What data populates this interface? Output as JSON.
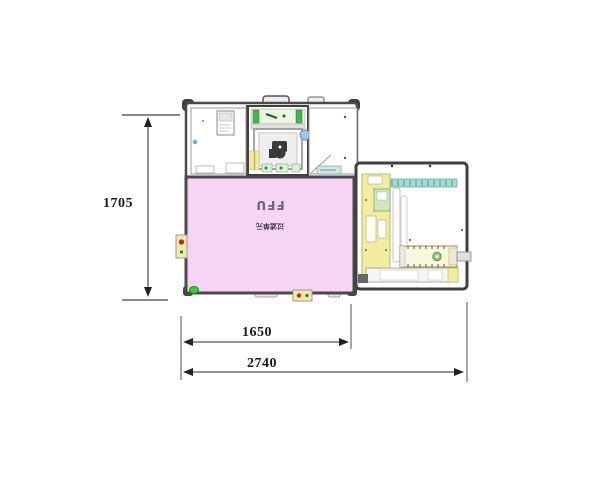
{
  "drawing": {
    "kind": "equipment-top-view-cad-layout",
    "ffu": {
      "label": "FFU",
      "sublabel": "过滤单元"
    },
    "dimensions": {
      "height": "1705",
      "inner_width": "1650",
      "total_width": "2740"
    },
    "colors": {
      "ffu_panel": "#F5D4F4",
      "frame": "#4A4A4A",
      "rail_teal": "#9FDCD2",
      "component_yellow": "#F2EC9E",
      "band_green": "#E8F6E0",
      "indicator_green": "#2FD32F",
      "indicator_red": "#C62828",
      "part_blue": "#9CC8EE"
    }
  }
}
